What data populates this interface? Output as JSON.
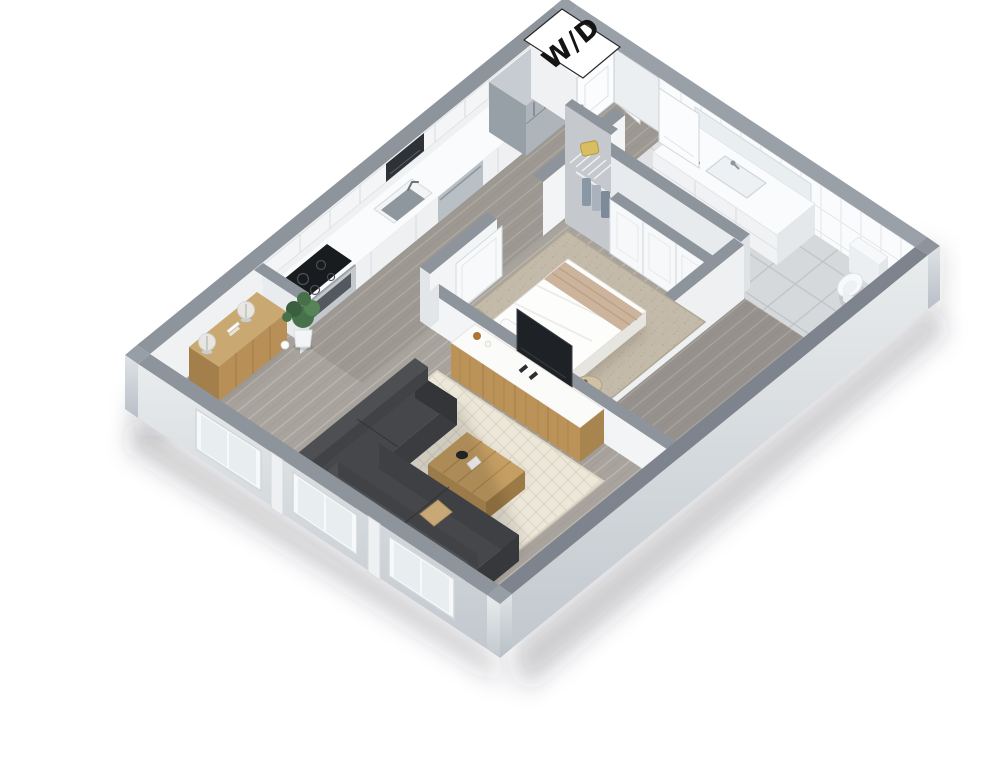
{
  "labels": {
    "washer_dryer": "W/D"
  },
  "palette": {
    "background": "#ffffff",
    "wall_cap": "#8d949c",
    "wall_inner_nw": "#eff1f3",
    "wall_inner_ne": "#f7f8f9",
    "partition_face": "#f2f4f6",
    "wood_floor": "#a8a39c",
    "plank_line": "#bfbab2",
    "tile_floor": "#d6d9db",
    "wall_tile": "#fafbfc",
    "bedroom_rug": "#c4baa9",
    "living_rug": "#ece7d9",
    "sofa": "#45474a",
    "sofa_dark": "#3a3c3f",
    "wood_furniture": "#bb9257",
    "counter_white": "#fafbfc",
    "stainless": "#adb5bb",
    "appliance_dark": "#33373c",
    "orange_pillow": "#dd8a3d",
    "throw_blanket": "#cbb39c",
    "plant_green": "#47714a",
    "tv_black": "#1e2226",
    "sign_bg": "#ffffff",
    "sign_text": "#141414",
    "accent_bag": "#d9bd62",
    "shadow": "rgba(45,50,58,0.22)"
  }
}
